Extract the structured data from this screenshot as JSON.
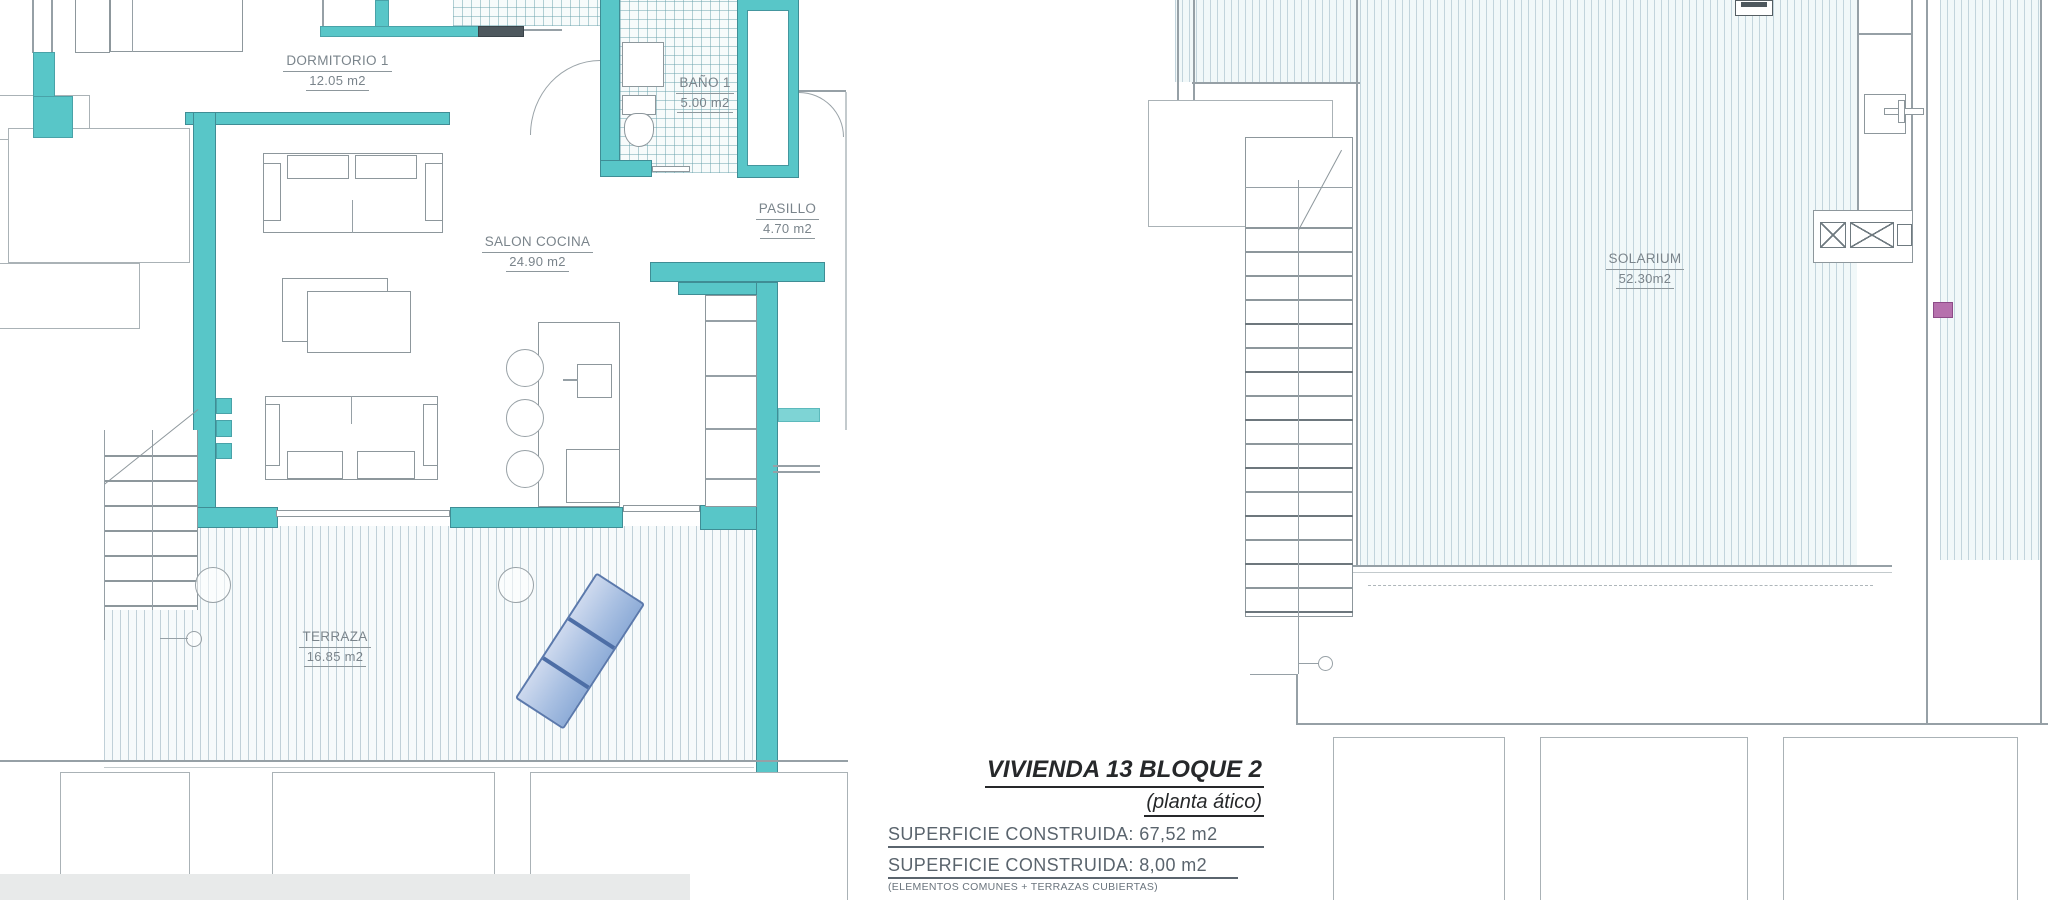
{
  "plans": {
    "left": {
      "rooms": [
        {
          "name": "DORMITORIO 1",
          "area": "12.05 m2"
        },
        {
          "name": "BAÑO 1",
          "area": "5.00 m2"
        },
        {
          "name": "SALON COCINA",
          "area": "24.90 m2"
        },
        {
          "name": "PASILLO",
          "area": "4.70 m2"
        },
        {
          "name": "TERRAZA",
          "area": "16.85 m2"
        }
      ]
    },
    "right": {
      "rooms": [
        {
          "name": "SOLARIUM",
          "area": "52.30m2"
        }
      ]
    }
  },
  "title_block": {
    "title": "VIVIENDA 13 BLOQUE 2",
    "subtitle": "(planta ático)",
    "surface_line1": "SUPERFICIE CONSTRUIDA: 67,52 m2",
    "surface_line2": "SUPERFICIE CONSTRUIDA: 8,00 m2",
    "surface_note": "(ELEMENTOS COMUNES + TERRAZAS CUBIERTAS)",
    "terraces_line": "TERRAZAS: 69,15 m2"
  },
  "colors": {
    "wall_teal": "#58c6c8",
    "wall_teal_light": "#7ed4d5",
    "wall_dark": "#4e585e",
    "line_gray": "#96a0a6",
    "lounger_blue": "#a9c0e2",
    "accent_magenta": "#b671ad"
  }
}
